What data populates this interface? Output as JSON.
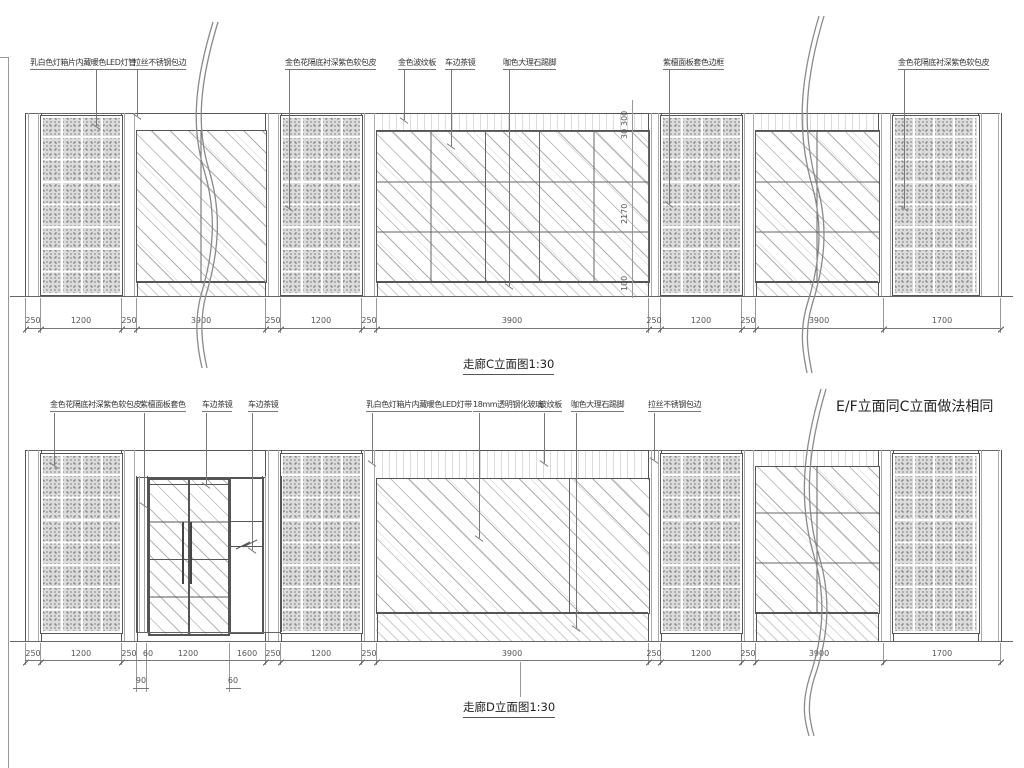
{
  "note": {
    "ef": "E/F立面同C立面做法相同"
  },
  "elevation_c": {
    "title": "走廊C立面图1:30",
    "callouts": {
      "c1": "乳白色灯箱片内藏暖色LED灯管",
      "c2": "拉丝不锈钢包边",
      "c3": "金色花隔底衬深紫色软包皮",
      "c4": "金色波纹板",
      "c5": "车边茶镜",
      "c6": "咖色大理石踢脚",
      "c7": "紫檀面板套色边框",
      "c8": "金色花隔底衬深紫色软包皮"
    },
    "dims": [
      "250",
      "1200",
      "250",
      "3900",
      "250",
      "1200",
      "250",
      "3900",
      "250",
      "1200",
      "250",
      "3900",
      "1700"
    ],
    "vdims": [
      "300",
      "30",
      "2170",
      "100"
    ]
  },
  "elevation_d": {
    "title": "走廊D立面图1:30",
    "callouts": {
      "d1": "金色花隔底衬深紫色软包皮",
      "d2": "紫檀面板套色",
      "d3": "车边茶镜",
      "d4": "车边茶镜",
      "d5": "乳白色灯箱片内藏暖色LED灯带",
      "d6": "18mm透明钢化玻璃",
      "d7": "波纹板",
      "d8": "咖色大理石踢脚",
      "d9": "拉丝不锈钢包边"
    },
    "dims": [
      "250",
      "1200",
      "250",
      "60",
      "1200",
      "1600",
      "250",
      "1200",
      "250",
      "3900",
      "250",
      "1200",
      "250",
      "3900",
      "1700"
    ],
    "subdims": [
      "90",
      "60"
    ]
  },
  "colors": {
    "line": "#555555",
    "text": "#333333"
  }
}
